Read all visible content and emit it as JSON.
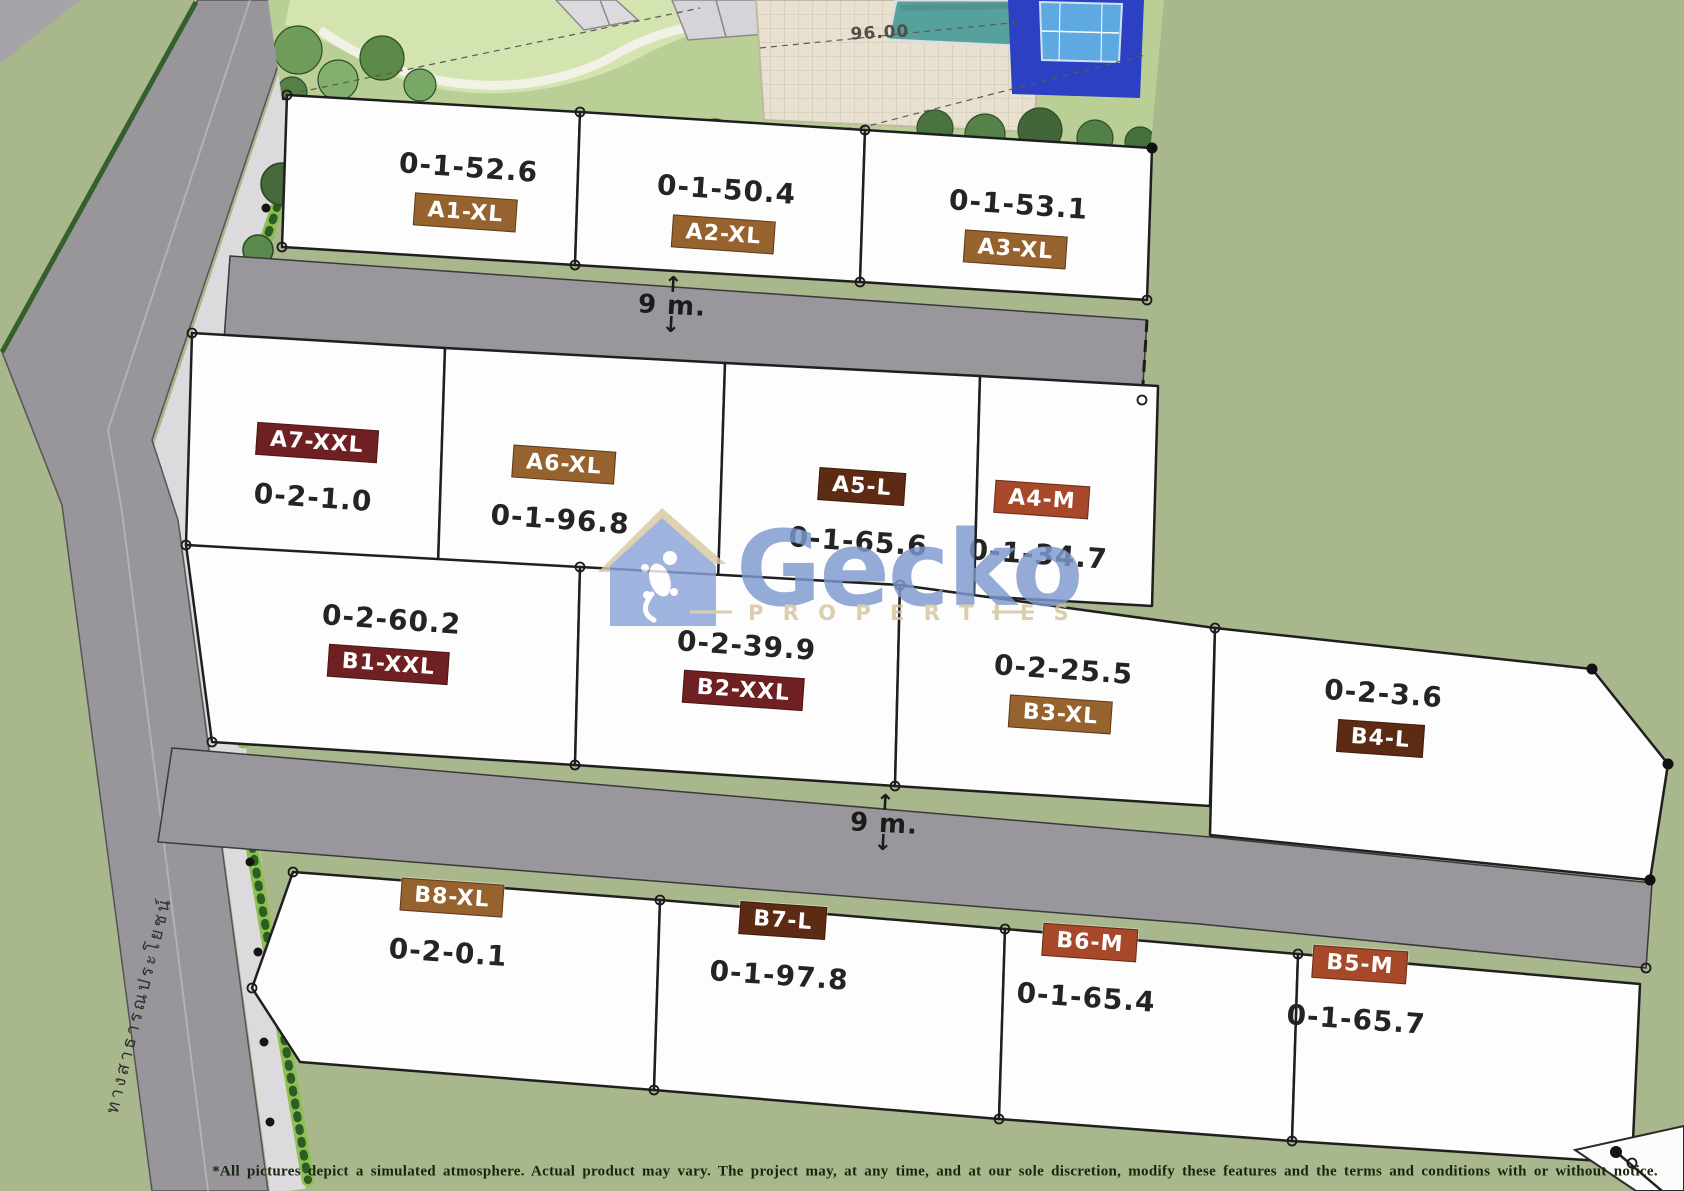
{
  "watermark": {
    "brand": "Gecko",
    "tagline": "P R O P E R T I E S"
  },
  "road_width_label": "9 m.",
  "pool_elevation": "96.00",
  "side_road_name": "ทางสาธารณประโยชน์",
  "disclaimer": "*All pictures depict a simulated atmosphere. Actual product may vary. The project may, at any time, and at our sole discretion, modify these features and the terms and conditions with or without notice.",
  "badge_colors": {
    "XL": "#96622e",
    "XXL": "#6f2022",
    "L": "#5d2b13",
    "M": "#a8482a"
  },
  "colors": {
    "background_green": "#a9b78d",
    "road_gray": "#98969a",
    "sidewalk": "#dcdadd",
    "plot_white": "#fdfdfd",
    "watermark_blue": "#7e98cf",
    "watermark_tan": "#d5c49c",
    "pool_teal": "#57a19d",
    "tennis_blue": "#2b40c2",
    "tennis_court_blue": "#5ea9e2"
  },
  "plots": [
    {
      "id": "A1-XL",
      "area": "0-1-52.6",
      "size": "XL"
    },
    {
      "id": "A2-XL",
      "area": "0-1-50.4",
      "size": "XL"
    },
    {
      "id": "A3-XL",
      "area": "0-1-53.1",
      "size": "XL"
    },
    {
      "id": "A7-XXL",
      "area": "0-2-1.0",
      "size": "XXL"
    },
    {
      "id": "A6-XL",
      "area": "0-1-96.8",
      "size": "XL"
    },
    {
      "id": "A5-L",
      "area": "0-1-65.6",
      "size": "L"
    },
    {
      "id": "A4-M",
      "area": "0-1-34.7",
      "size": "M"
    },
    {
      "id": "B1-XXL",
      "area": "0-2-60.2",
      "size": "XXL"
    },
    {
      "id": "B2-XXL",
      "area": "0-2-39.9",
      "size": "XXL"
    },
    {
      "id": "B3-XL",
      "area": "0-2-25.5",
      "size": "XL"
    },
    {
      "id": "B4-L",
      "area": "0-2-3.6",
      "size": "L"
    },
    {
      "id": "B8-XL",
      "area": "0-2-0.1",
      "size": "XL"
    },
    {
      "id": "B7-L",
      "area": "0-1-97.8",
      "size": "L"
    },
    {
      "id": "B6-M",
      "area": "0-1-65.4",
      "size": "M"
    },
    {
      "id": "B5-M",
      "area": "0-1-65.7",
      "size": "M"
    }
  ]
}
